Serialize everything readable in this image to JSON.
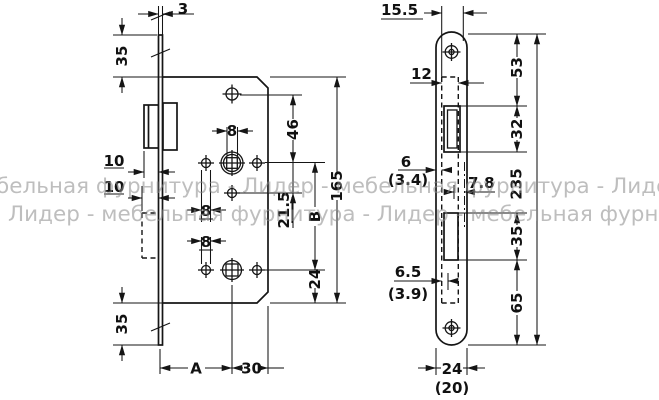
{
  "watermark": {
    "line1": "бельная фурнитура - Лидер - мебельная фурнитура - Лидер",
    "line2": "Лидер - мебельная фурнитура - Лидер - мебельная фурнит"
  },
  "left_view": {
    "dims": {
      "plate_thickness": "3",
      "top_margin": "35",
      "bottom_margin": "35",
      "latch_protrusion": "10",
      "bolt_protrusion": "10",
      "square_width": "8",
      "pin_hole": "8",
      "lower_hole": "8",
      "hole_to_spindle": "46",
      "body_height": "165",
      "spindle_to_pin": "21.5",
      "follower_distance": "B",
      "follower_to_bottom": "24",
      "backset": "A",
      "spindle_to_edge": "30"
    }
  },
  "right_view": {
    "dims": {
      "case_offset": "15.5",
      "case_width": "12",
      "edge_margin": "6",
      "edge_margin_alt": "(3.4)",
      "latch_center": "7.8",
      "lower_margin": "6.5",
      "lower_margin_alt": "(3.9)",
      "top_to_latch": "53",
      "latch_cutout": "32",
      "bolt_cutout": "35",
      "bolt_to_bottom": "65",
      "plate_height": "235",
      "plate_width": "24",
      "plate_width_alt": "(20)"
    }
  }
}
